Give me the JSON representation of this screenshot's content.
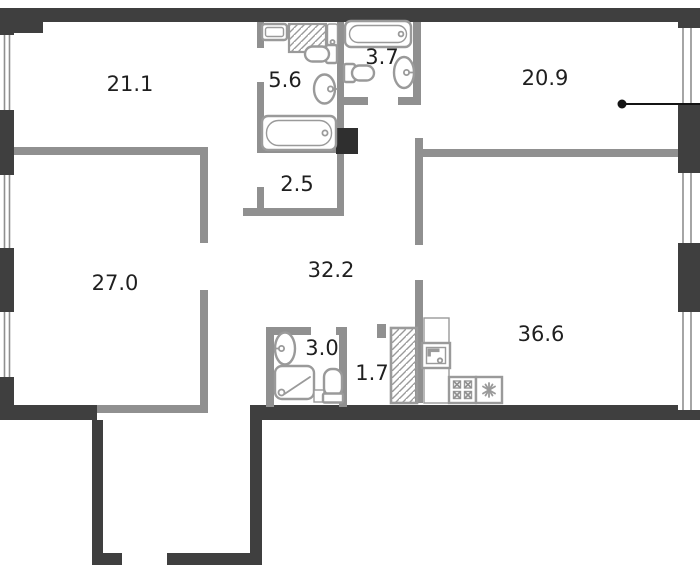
{
  "rooms": [
    {
      "name": "room-21-1",
      "area_label": "21.1"
    },
    {
      "name": "room-5-6",
      "area_label": "5.6"
    },
    {
      "name": "room-3-7",
      "area_label": "3.7"
    },
    {
      "name": "room-20-9",
      "area_label": "20.9"
    },
    {
      "name": "room-2-5",
      "area_label": "2.5"
    },
    {
      "name": "room-27-0",
      "area_label": "27.0"
    },
    {
      "name": "room-32-2",
      "area_label": "32.2"
    },
    {
      "name": "room-3-0",
      "area_label": "3.0"
    },
    {
      "name": "room-1-7",
      "area_label": "1.7"
    },
    {
      "name": "room-36-6",
      "area_label": "36.6"
    }
  ],
  "colors": {
    "outer_wall": "#3f3f3f",
    "inner_wall": "#909090",
    "background": "#ffffff",
    "label_text": "#1f1f1f",
    "fixture_outline": "#9a9a9a",
    "shaft_block": "#2f2f2f",
    "leader": "#141414"
  },
  "icons": {
    "washing_machine": "hatched-square",
    "ventilation_shaft": "hatched-rect",
    "bathtub": "double-rounded-rect",
    "toilet": "tank-and-bowl",
    "washbasin": "oval-with-faucet",
    "shower_tray": "rounded-square-diagonal",
    "kitchen_sink": "square-with-faucet",
    "stove": "four-burners",
    "refrigerator": "snowflake",
    "window": "double-line-strip",
    "entrance_marker": "dot-with-leader-line"
  }
}
